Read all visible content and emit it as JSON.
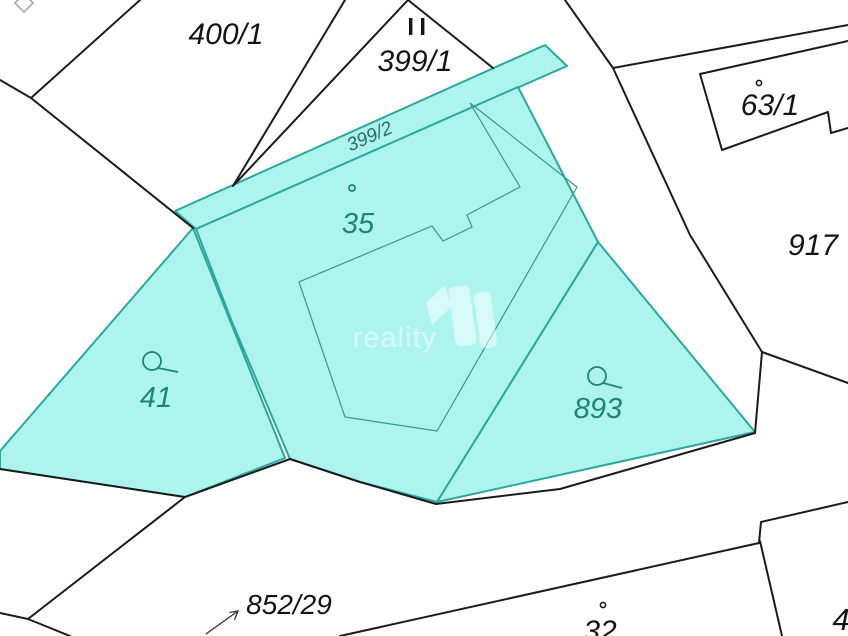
{
  "title": "Cadastral map extract",
  "colors": {
    "parcel_fill": "#adf4ef",
    "parcel_border": "#2aa89a",
    "teal_label": "#1d8476",
    "strip_label": "#2a6e63",
    "black_line": "#1b1b1b",
    "black_label": "#141414",
    "gray_marker": "#9aa4a4",
    "watermark": "#ffffff",
    "bg": "#ffffff"
  },
  "watermark": {
    "text": "reality",
    "logo": "reality-house-logo"
  },
  "parcels": [
    {
      "id": "400-1",
      "label": "400/1",
      "highlighted": false,
      "marker": "none"
    },
    {
      "id": "399-1",
      "label": "399/1",
      "highlighted": false,
      "marker": "double-bar"
    },
    {
      "id": "399-2",
      "label": "399/2",
      "highlighted": true,
      "marker": "none"
    },
    {
      "id": "35",
      "label": "35",
      "highlighted": true,
      "marker": "building-dot"
    },
    {
      "id": "63-1",
      "label": "63/1",
      "highlighted": false,
      "marker": "building-dot"
    },
    {
      "id": "917",
      "label": "917",
      "highlighted": false,
      "marker": "none"
    },
    {
      "id": "41",
      "label": "41",
      "highlighted": true,
      "marker": "circle-tail"
    },
    {
      "id": "893",
      "label": "893",
      "highlighted": true,
      "marker": "circle-tail"
    },
    {
      "id": "852-29",
      "label": "852/29",
      "highlighted": false,
      "marker": "arrow"
    },
    {
      "id": "32",
      "label": "32",
      "highlighted": false,
      "marker": "building-dot"
    },
    {
      "id": "4",
      "label": "4",
      "highlighted": false,
      "marker": "none"
    }
  ]
}
